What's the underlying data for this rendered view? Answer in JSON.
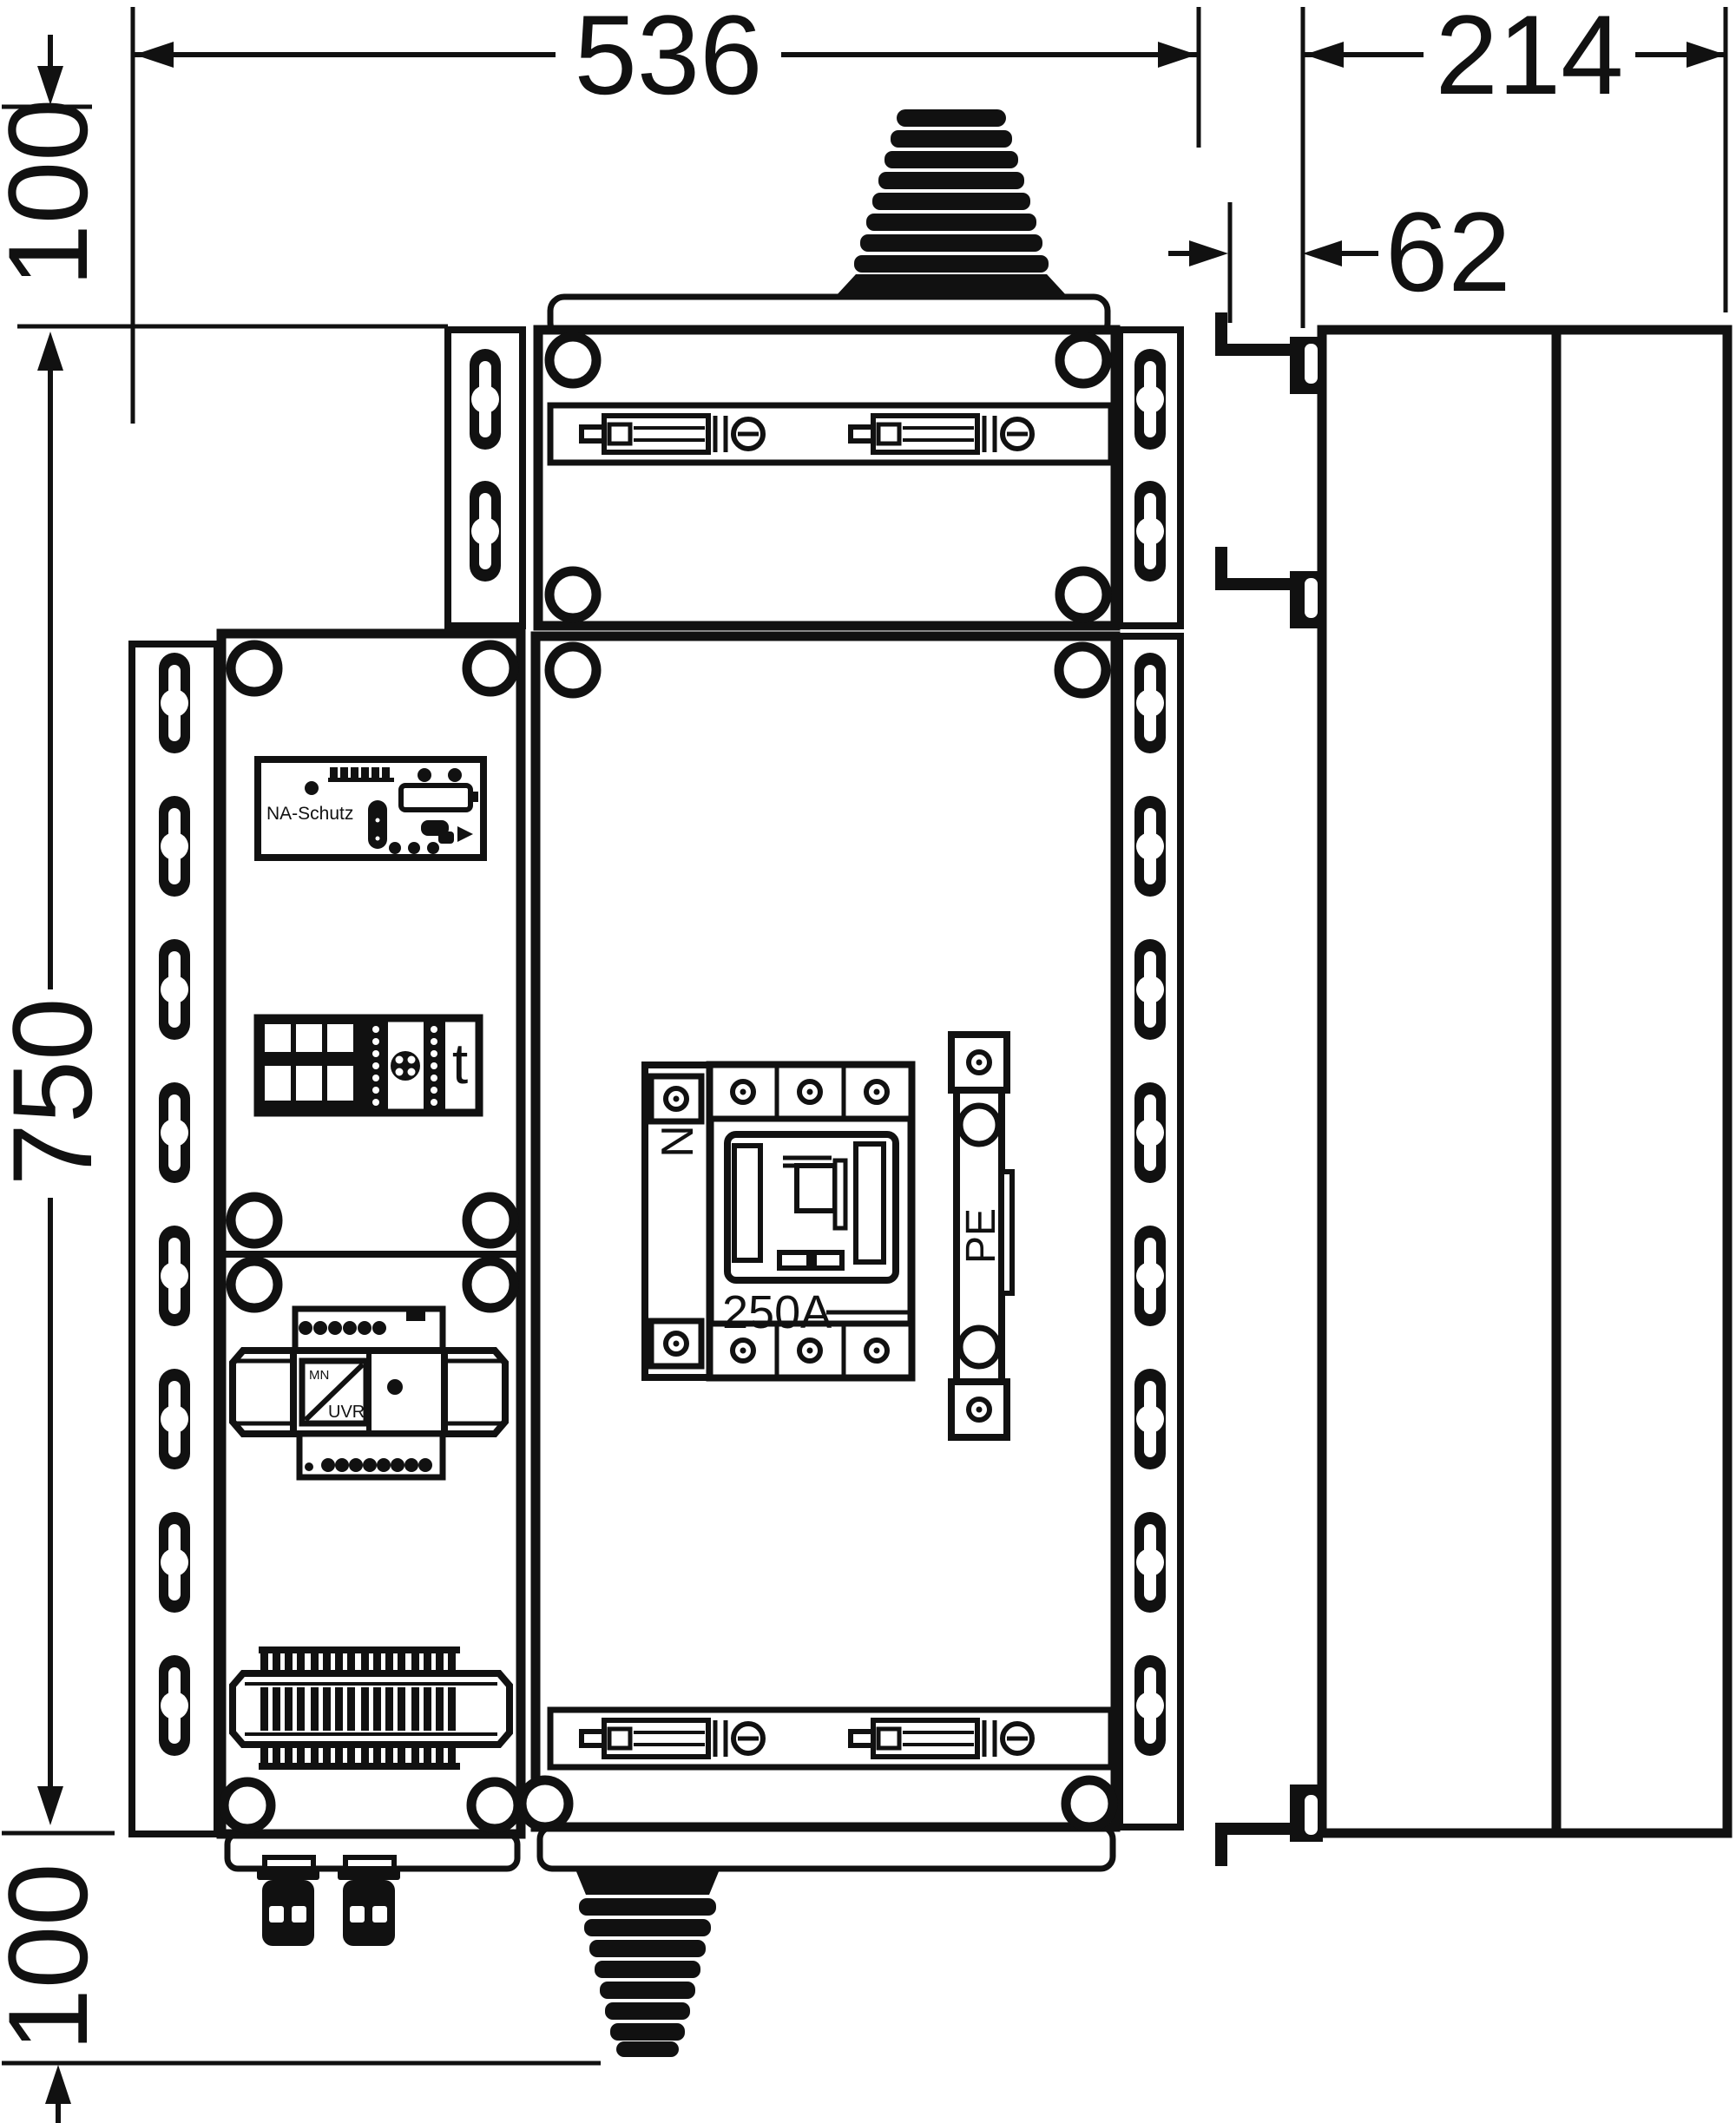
{
  "dimensions": {
    "top_width_mm": "536",
    "side_depth_mm": "214",
    "cover_depth_mm": "62",
    "gland_top_offset_mm": "100",
    "front_height_mm": "750",
    "gland_bottom_offset_mm": "100"
  },
  "devices": {
    "na_schutz_label": "NA-Schutz",
    "timer_label": "t",
    "neutral_label": "N",
    "main_switch_rating": "250A",
    "earth_label": "PE",
    "uvr_mn_label": "MN",
    "uvr_label": "UVR"
  },
  "colors": {
    "line": "#111111",
    "background": "#ffffff"
  }
}
